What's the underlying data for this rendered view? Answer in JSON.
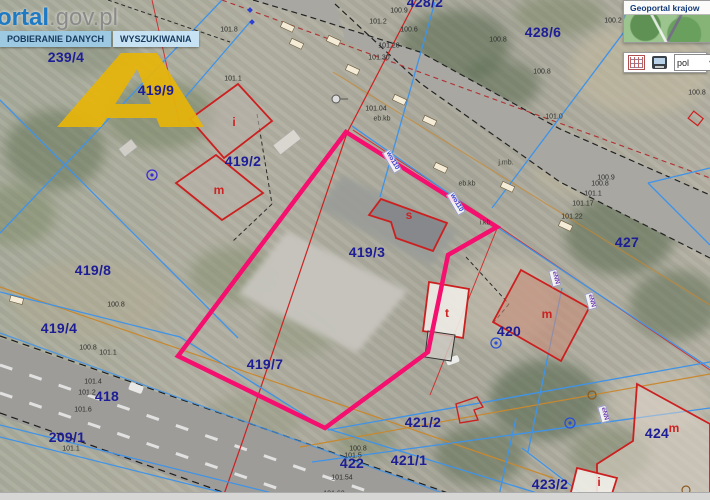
{
  "header": {
    "logo_text": "ortal",
    "logo_suffix": ".gov.pl",
    "tabs": [
      {
        "label": "POBIERANIE DANYCH"
      },
      {
        "label": "WYSZUKIWANIA"
      }
    ]
  },
  "side_panel": {
    "title": "Geoportal krajow",
    "language": "pol",
    "icons": [
      "attribute-grid-icon",
      "screen-icon",
      "chevron-down-icon"
    ]
  },
  "colors": {
    "highlight_outline": "#f50f6e",
    "parcel_label": "#1d1d96",
    "building_label": "#cc2222",
    "cadastral_line": "#3f93e8",
    "building_outline": "#cc2020",
    "watermark": "#e6b50a"
  },
  "map": {
    "parcel_labels": [
      {
        "text": "239/4",
        "x": 66,
        "y": 57
      },
      {
        "text": "419/9",
        "x": 156,
        "y": 90
      },
      {
        "text": "419/2",
        "x": 243,
        "y": 161
      },
      {
        "text": "419/8",
        "x": 93,
        "y": 270
      },
      {
        "text": "419/4",
        "x": 59,
        "y": 328
      },
      {
        "text": "419/3",
        "x": 367,
        "y": 252
      },
      {
        "text": "419/7",
        "x": 265,
        "y": 364
      },
      {
        "text": "418",
        "x": 107,
        "y": 396
      },
      {
        "text": "209/1",
        "x": 67,
        "y": 437
      },
      {
        "text": "422",
        "x": 352,
        "y": 463
      },
      {
        "text": "421/1",
        "x": 409,
        "y": 460
      },
      {
        "text": "421/2",
        "x": 423,
        "y": 422
      },
      {
        "text": "420",
        "x": 509,
        "y": 331
      },
      {
        "text": "427",
        "x": 627,
        "y": 242
      },
      {
        "text": "428/6",
        "x": 543,
        "y": 32
      },
      {
        "text": "428/2",
        "x": 425,
        "y": 2
      },
      {
        "text": "423/2",
        "x": 550,
        "y": 484
      },
      {
        "text": "424",
        "x": 657,
        "y": 433
      }
    ],
    "building_labels": [
      {
        "text": "i",
        "x": 234,
        "y": 122
      },
      {
        "text": "m",
        "x": 219,
        "y": 190
      },
      {
        "text": "s",
        "x": 409,
        "y": 215
      },
      {
        "text": "t",
        "x": 447,
        "y": 313
      },
      {
        "text": "m",
        "x": 547,
        "y": 314
      },
      {
        "text": "m",
        "x": 674,
        "y": 428
      },
      {
        "text": "i",
        "x": 599,
        "y": 482
      }
    ],
    "elevation_labels": [
      {
        "text": "101.8",
        "x": 229,
        "y": 30
      },
      {
        "text": "101.1",
        "x": 233,
        "y": 79
      },
      {
        "text": "100.9",
        "x": 399,
        "y": 11
      },
      {
        "text": "101.2",
        "x": 378,
        "y": 22
      },
      {
        "text": "100.6",
        "x": 409,
        "y": 30
      },
      {
        "text": "101.28",
        "x": 389,
        "y": 46
      },
      {
        "text": "101.30",
        "x": 379,
        "y": 58
      },
      {
        "text": "100.8",
        "x": 498,
        "y": 40
      },
      {
        "text": "100.2",
        "x": 613,
        "y": 21
      },
      {
        "text": "100.8",
        "x": 542,
        "y": 72
      },
      {
        "text": "100.8",
        "x": 697,
        "y": 93
      },
      {
        "text": "101.0",
        "x": 554,
        "y": 117
      },
      {
        "text": "101.04",
        "x": 376,
        "y": 109
      },
      {
        "text": "100.9",
        "x": 606,
        "y": 178
      },
      {
        "text": "100.8",
        "x": 600,
        "y": 184
      },
      {
        "text": "101.1",
        "x": 593,
        "y": 194
      },
      {
        "text": "101.17",
        "x": 583,
        "y": 204
      },
      {
        "text": "101.22",
        "x": 572,
        "y": 217
      },
      {
        "text": "100.8",
        "x": 116,
        "y": 305
      },
      {
        "text": "100.8",
        "x": 88,
        "y": 348
      },
      {
        "text": "101.1",
        "x": 108,
        "y": 353
      },
      {
        "text": "101.4",
        "x": 93,
        "y": 382
      },
      {
        "text": "101.2",
        "x": 87,
        "y": 393
      },
      {
        "text": "101.6",
        "x": 83,
        "y": 410
      },
      {
        "text": "101.1",
        "x": 71,
        "y": 449
      },
      {
        "text": "100.8",
        "x": 358,
        "y": 449
      },
      {
        "text": "101.5",
        "x": 353,
        "y": 456
      },
      {
        "text": "101.54",
        "x": 342,
        "y": 478
      },
      {
        "text": "101.62",
        "x": 334,
        "y": 494
      }
    ],
    "utility_labels": [
      {
        "text": "eb.kb",
        "x": 382,
        "y": 119
      },
      {
        "text": "eb.kb",
        "x": 467,
        "y": 184
      },
      {
        "text": "j.mb.",
        "x": 506,
        "y": 163
      },
      {
        "text": "i.kb",
        "x": 485,
        "y": 223
      }
    ],
    "rotated_labels": [
      {
        "text": "wo110",
        "x": 392,
        "y": 161,
        "angle": 60,
        "color": "#2b3fd4"
      },
      {
        "text": "wo110",
        "x": 456,
        "y": 203,
        "angle": 60,
        "color": "#2b3fd4"
      },
      {
        "text": "eNN",
        "x": 555,
        "y": 278,
        "angle": 75,
        "color": "#7040b0"
      },
      {
        "text": "eNN",
        "x": 591,
        "y": 301,
        "angle": 75,
        "color": "#7040b0"
      },
      {
        "text": "eNN",
        "x": 604,
        "y": 414,
        "angle": 75,
        "color": "#7040b0"
      }
    ]
  }
}
